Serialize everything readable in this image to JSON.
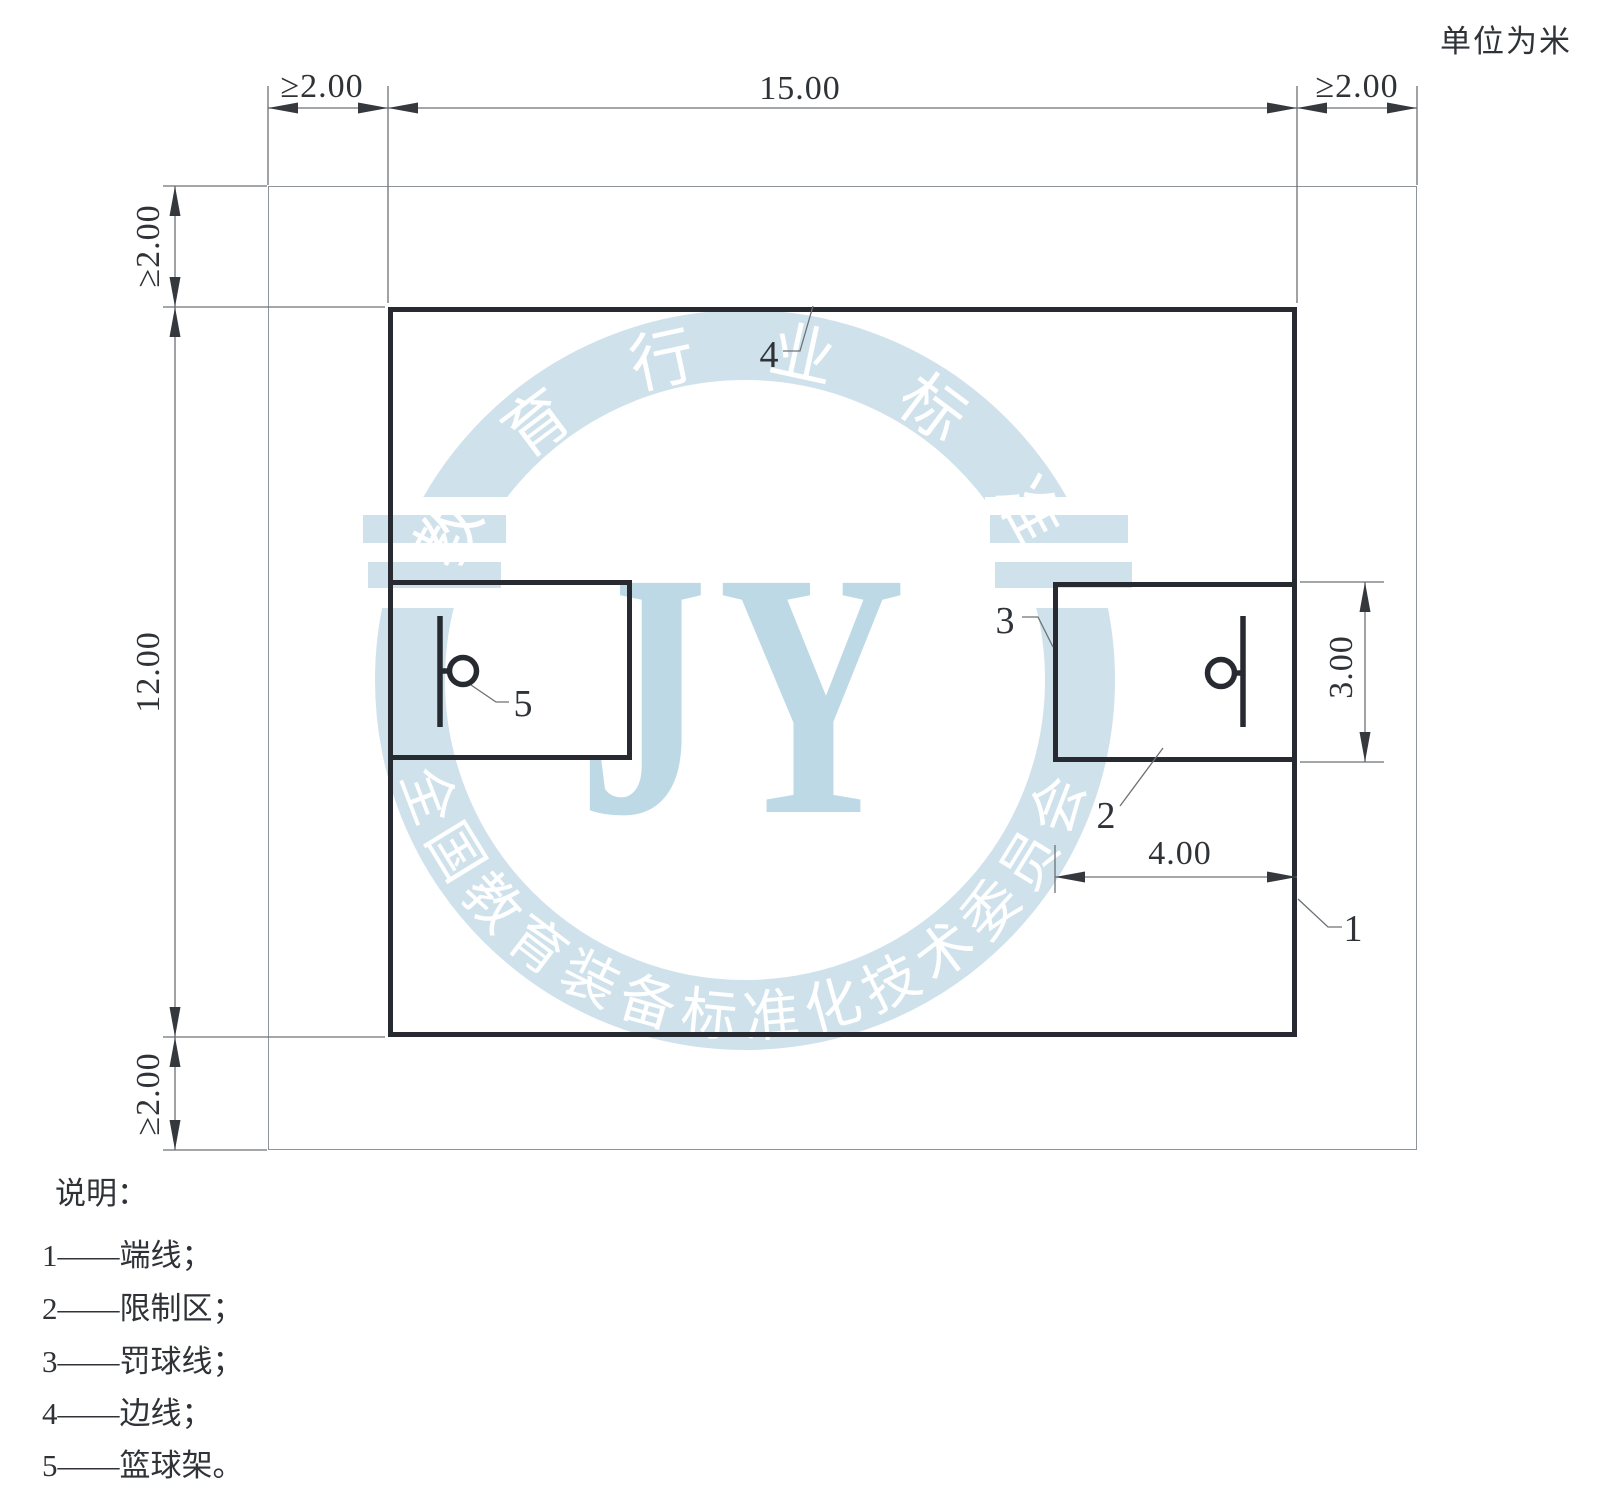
{
  "units_note": "单位为米",
  "dims": {
    "buffer_left": "≥2.00",
    "court_width": "15.00",
    "buffer_right": "≥2.00",
    "buffer_top": "≥2.00",
    "court_length": "12.00",
    "buffer_bottom": "≥2.00",
    "key_depth": "3.00",
    "key_width": "4.00"
  },
  "callouts": {
    "endline": "1",
    "restricted_area": "2",
    "free_throw_line": "3",
    "sideline": "4",
    "hoop": "5"
  },
  "legend": {
    "heading": "说明：",
    "items": [
      {
        "text": "1——端线；"
      },
      {
        "text": "2——限制区；"
      },
      {
        "text": "3——罚球线；"
      },
      {
        "text": "4——边线；"
      },
      {
        "text": "5——篮球架。"
      }
    ]
  },
  "watermark": {
    "arc_top": "教 育 行 业 标 准",
    "arc_bottom": "全国教育装备标准化技术委员会",
    "monogram": "JY",
    "band_color": "#cfe2ec",
    "monogram_color": "#bed9e6"
  },
  "colors": {
    "court_line": "#272b31",
    "boundary_line": "#8f9498",
    "dim_line": "#6d7175",
    "arrow": "#35393e",
    "text": "#2f3338"
  }
}
